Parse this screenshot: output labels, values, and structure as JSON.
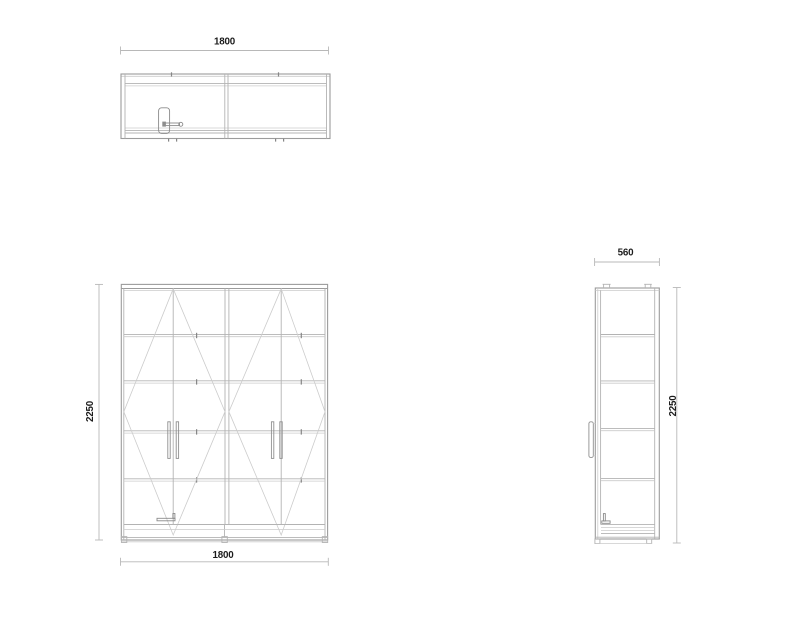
{
  "dims": {
    "top_width": "1800",
    "front_height": "2250",
    "front_width": "1800",
    "side_depth": "560",
    "side_height": "2250"
  },
  "colors": {
    "background": "#ffffff",
    "outline": "#9b9b9b",
    "line_medium": "#b3b3b3",
    "line_light": "#cccccc",
    "tick_dark": "#868686",
    "dimension_line": "#b8b8b8",
    "text": "#1c1c1c"
  }
}
